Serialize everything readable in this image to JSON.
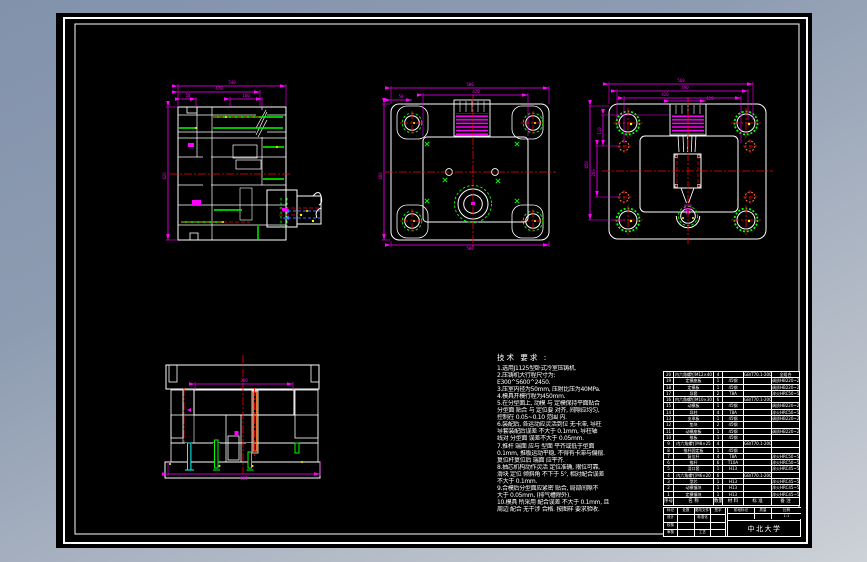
{
  "notes": {
    "title": "技术 要求 :",
    "lines": [
      "1.选用J1125型卧式冷室压铸机.",
      "2.压铸机大行程尺寸为:",
      "E300^5600^2450.",
      "3.压室内径为50mm, 压射比压为40MPa.",
      "4.模具开模行程为450mm.",
      "5.在分型面上, 动模 与 定模保持平面贴合",
      "分型面 贴合 与 定位要 对齐, 间隙应均匀,",
      "控制在 0.05~0.10 范围 内.",
      "6.装配后, 各运动应灵活到位 无卡滞, 导柱",
      "导套装配后误差 不大于 0.1mm, 导柱轴",
      "线对 分型面 误差不大于 0.05mm.",
      "7.推杆 端面 应与 型面 平齐或低于型面",
      "0.1mm, 推板运动平稳, 不得有卡滞与偏摆.",
      "复位杆复位后 端面 应平齐.",
      "8.抽芯机构动作灵活 定位准确, 限位可靠,",
      "滑块 定位 倾斜角 不下于 5°, 相对配合误差",
      "不大于 0.1mm.",
      "9.合模后分型面应紧密 贴合, 局部间隙不",
      "大于 0.05mm, (排气槽除外).",
      "10.模具 所采用 配合误差 不大于 0.1mm, 且",
      "周边 配合 无干涉 合格. 按图样 要求验收."
    ]
  },
  "bom": {
    "headers": [
      "序号",
      "名  称",
      "数量",
      "材 料",
      "标  准",
      "备  注"
    ],
    "rows": [
      [
        "20",
        "内六角螺钉M12×40",
        "4",
        "",
        "GB/T70.1-2000",
        "全组合"
      ],
      [
        "19",
        "定模座板",
        "1",
        "45钢",
        "",
        "调质HB220~250"
      ],
      [
        "18",
        "定模板",
        "1",
        "45钢",
        "",
        "调质HB220~250"
      ],
      [
        "17",
        "导套",
        "2",
        "T8A",
        "",
        "淬火HRC50~55"
      ],
      [
        "16",
        "内六角螺钉M10×30",
        "6",
        "",
        "GB/T70.1-2000",
        ""
      ],
      [
        "15",
        "动模板",
        "1",
        "45钢",
        "",
        "调质HB220~250"
      ],
      [
        "14",
        "导柱",
        "4",
        "T8A",
        "",
        "淬火HRC50~55"
      ],
      [
        "13",
        "支承板",
        "1",
        "45钢",
        "",
        "调质HB220~250"
      ],
      [
        "12",
        "垫块",
        "2",
        "45钢",
        "",
        ""
      ],
      [
        "11",
        "动模座板",
        "1",
        "45钢",
        "",
        "调质HB220~250"
      ],
      [
        "10",
        "推板",
        "1",
        "45钢",
        "",
        ""
      ],
      [
        "9",
        "内六角螺钉M8×25",
        "4",
        "",
        "GB/T70.1-2000",
        ""
      ],
      [
        "8",
        "推杆固定板",
        "1",
        "45钢",
        "",
        ""
      ],
      [
        "7",
        "复位杆",
        "4",
        "T8A",
        "",
        "淬火HRC50~55"
      ],
      [
        "6",
        "推杆",
        "6",
        "T10A",
        "",
        "淬火HRC50~55"
      ],
      [
        "5",
        "浇口套",
        "1",
        "H13",
        "",
        "淬火HRC45~50"
      ],
      [
        "4",
        "内六角螺钉M6×20",
        "6",
        "",
        "GB/T70.1-2000",
        ""
      ],
      [
        "3",
        "型芯",
        "1",
        "H13",
        "",
        "淬火HRC45~50"
      ],
      [
        "2",
        "动模镶块",
        "1",
        "H13",
        "",
        "淬火HRC45~50"
      ],
      [
        "1",
        "定模镶块",
        "1",
        "H13",
        "",
        "淬火HRC45~50"
      ]
    ]
  },
  "title_block": {
    "mark": "标记",
    "count": "处数",
    "change_doc": "更改文件号",
    "sign": "签字",
    "design": "设计",
    "standardize": "标准化",
    "check": "校核",
    "audit": "审核",
    "process": "工艺",
    "stage_mark": "阶段标记",
    "weight": "质量",
    "scale": "比例",
    "scale_value": "1:1",
    "org": "中北大学"
  },
  "dims": {
    "a1": "540",
    "a2": "470",
    "a3": "50",
    "a4": "160",
    "a5": "420",
    "b1": "500",
    "b2": "420",
    "b3": "50",
    "b4": "480",
    "b5": "500",
    "c1": "560",
    "c2": "490",
    "c3": "420",
    "c4": "120",
    "c5": "450",
    "c6": "260",
    "c7": "110",
    "d1": "380",
    "d2": "650"
  },
  "colors": {
    "background_top": "#8292ab",
    "background_bottom": "#cdd1d8",
    "canvas": "#000000",
    "line": "#ffffff",
    "dimension": "#ff00ff",
    "centerline": "#ff0000",
    "fastener": "#00ff00",
    "pin": "#00ffff",
    "sprue": "#ff7f2a",
    "flow": "#4169ff",
    "dot": "#ffff00"
  }
}
